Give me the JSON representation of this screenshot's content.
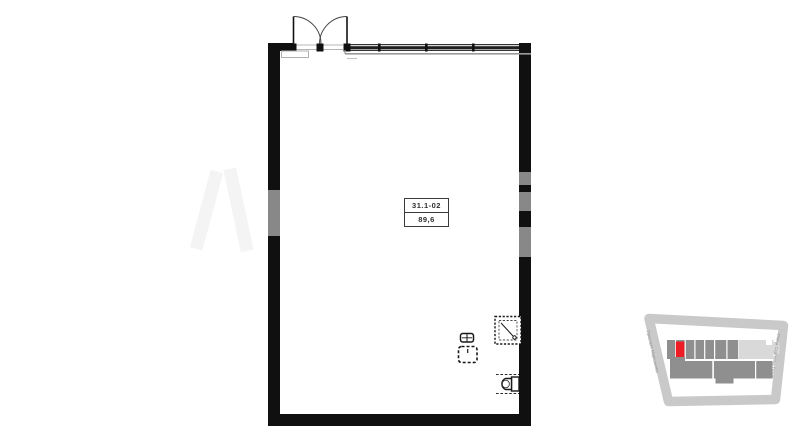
{
  "unit_label": {
    "id": "31.1-02",
    "area": "89,6"
  },
  "plan": {
    "wall_color": "#101010",
    "window_color": "#1f1f1f",
    "exterior_line_color": "#9a9a9a",
    "fixture_icons": [
      "entrance-double-door-icon",
      "window-strip-icon",
      "shower-tray-icon",
      "sink-icon",
      "washing-machine-icon",
      "toilet-icon"
    ]
  },
  "minimap": {
    "street_left": "Проспект Маршакова",
    "street_right": "Улица Сергеева-Тракт",
    "road_color": "#c9c9c9",
    "building_color": "#8f8f8f",
    "building_light_color": "#d9d9d9",
    "highlight_color": "#ee1c24",
    "street_text_color": "#8f8f8f"
  }
}
